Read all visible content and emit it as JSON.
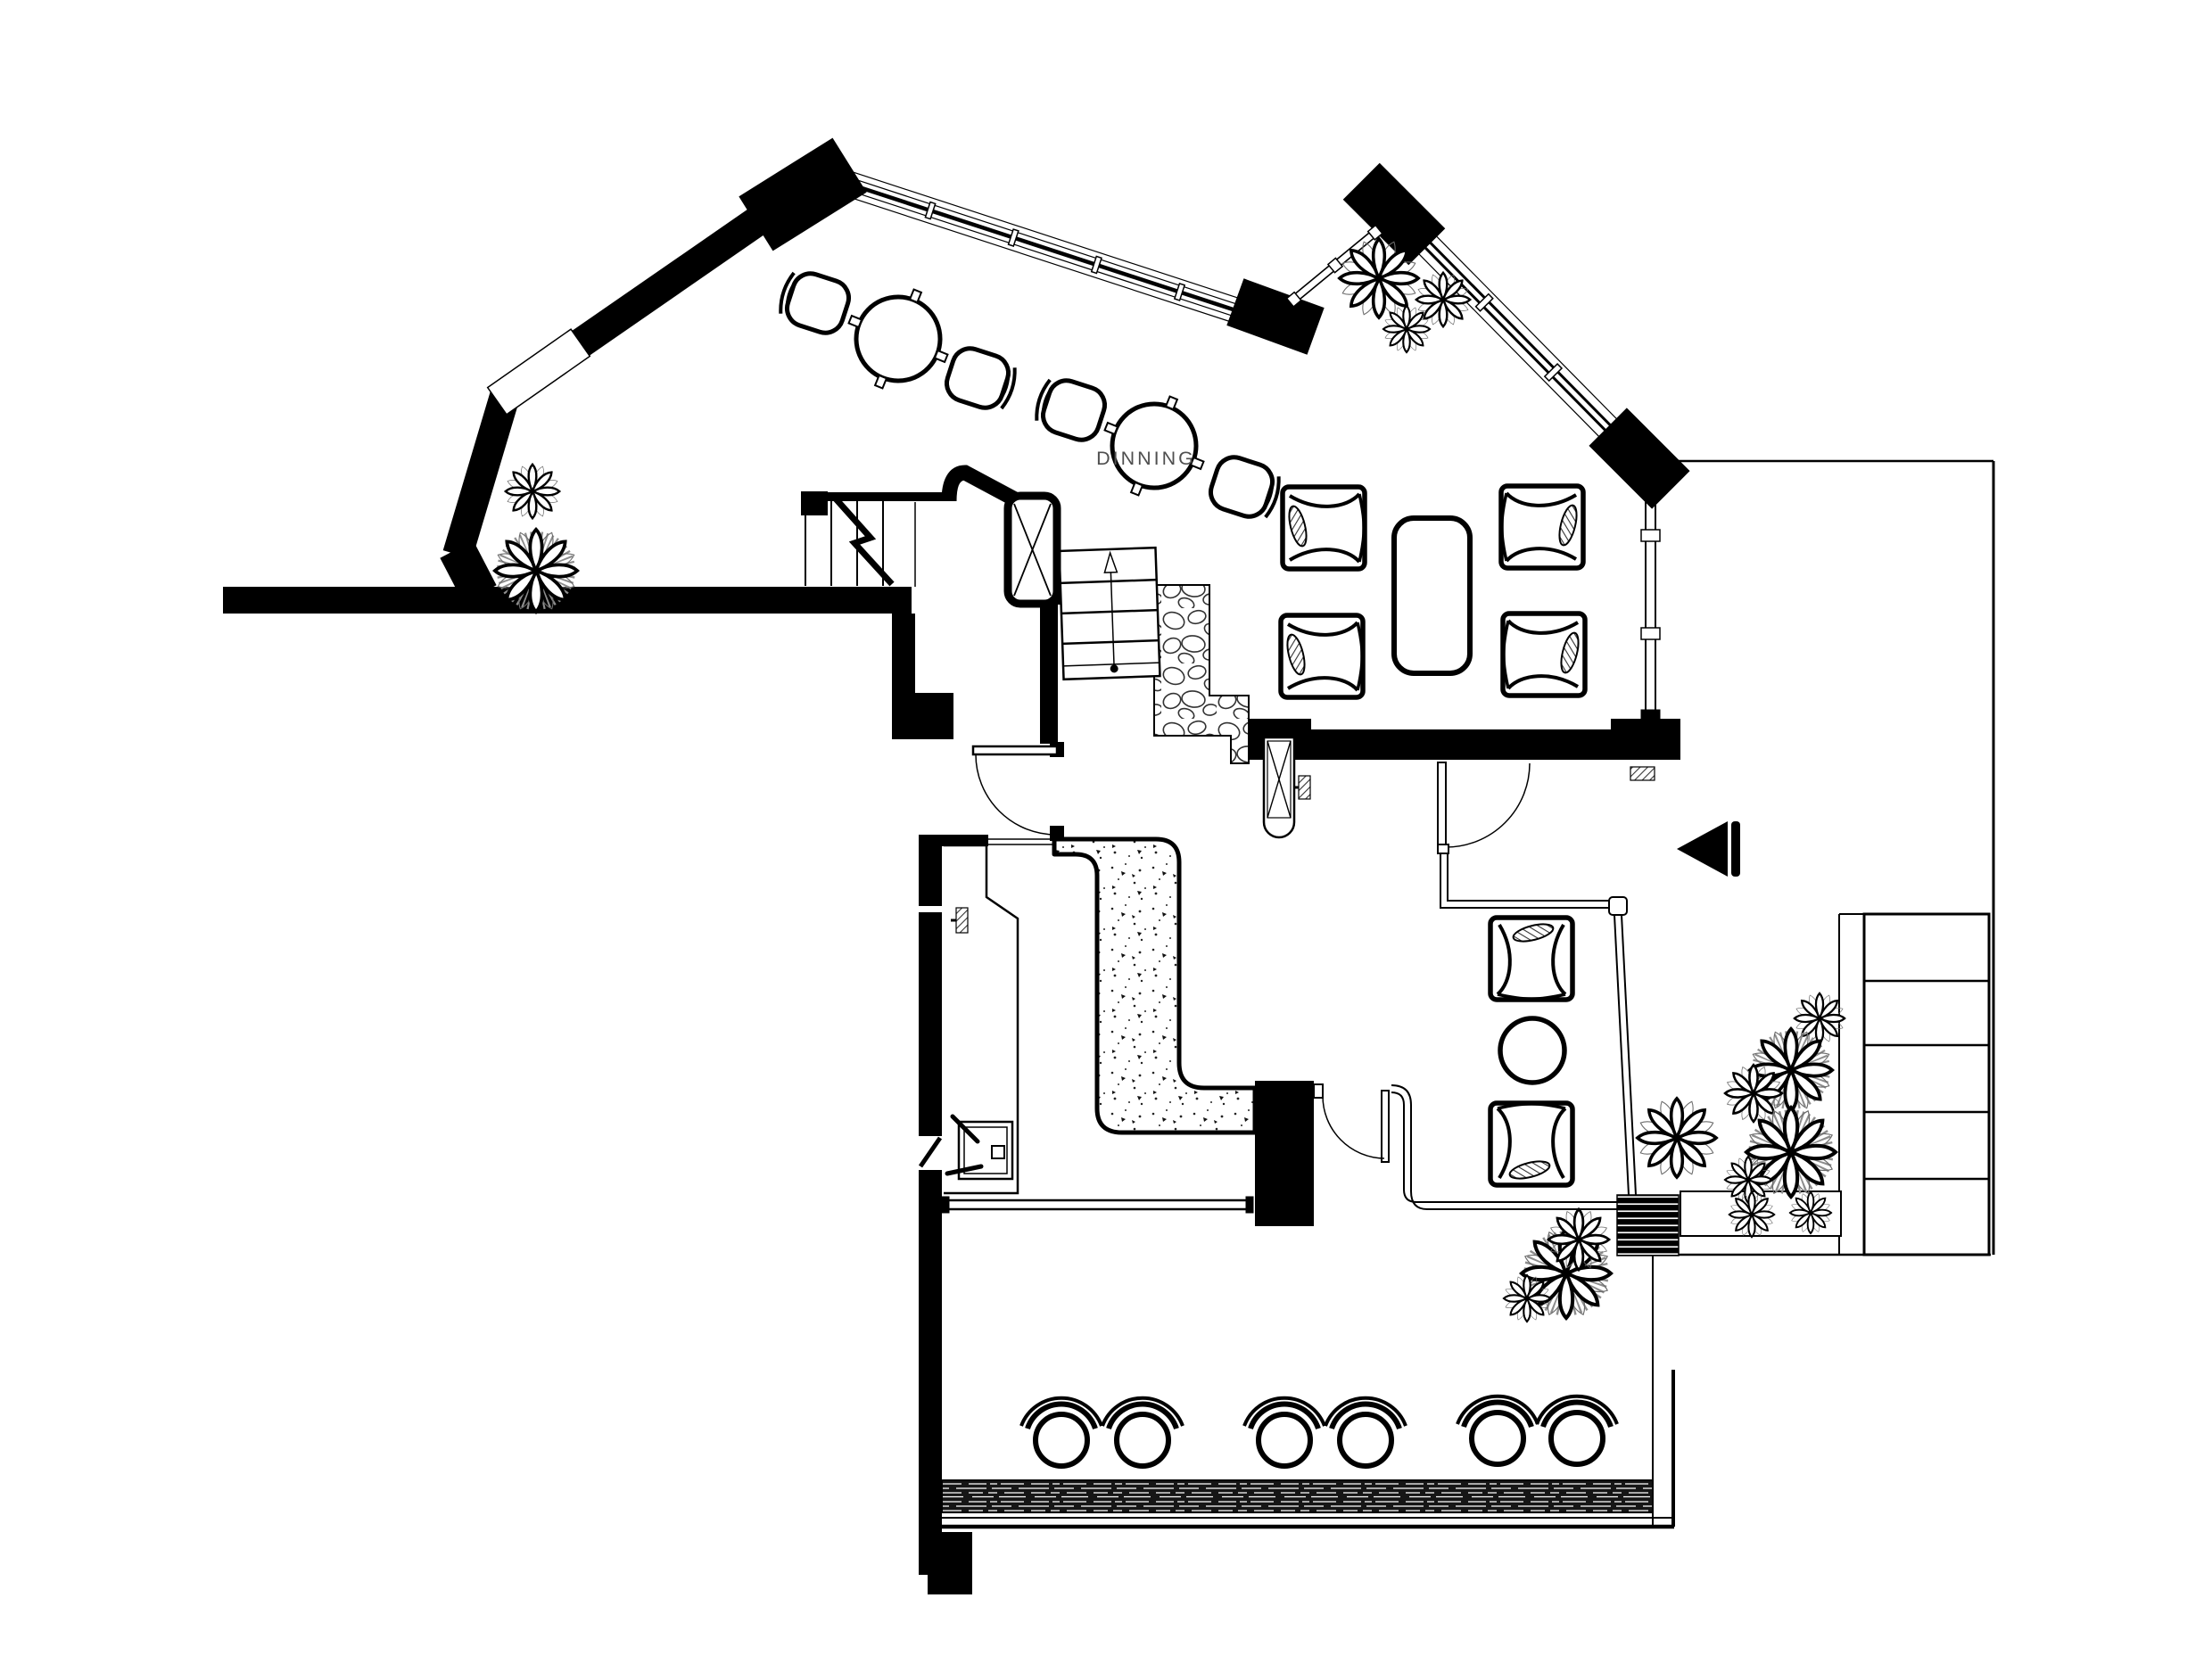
{
  "plan": {
    "room_label": "DINNING",
    "ink_color": "#000000",
    "label_color": "#4f4f4f",
    "paper_color": "#ffffff",
    "hatch_color": "#333333"
  },
  "inventory": {
    "window_seat_chairs": 4,
    "window_round_tables": 2,
    "dining_armchairs": 4,
    "dining_table": 1,
    "lounge_armchairs": 2,
    "lounge_round_table": 1,
    "bar_stools": 6,
    "staircases": 2,
    "swing_doors": 3,
    "plants": 16,
    "kitchen_sink": 1,
    "entry_arrow": 1
  }
}
